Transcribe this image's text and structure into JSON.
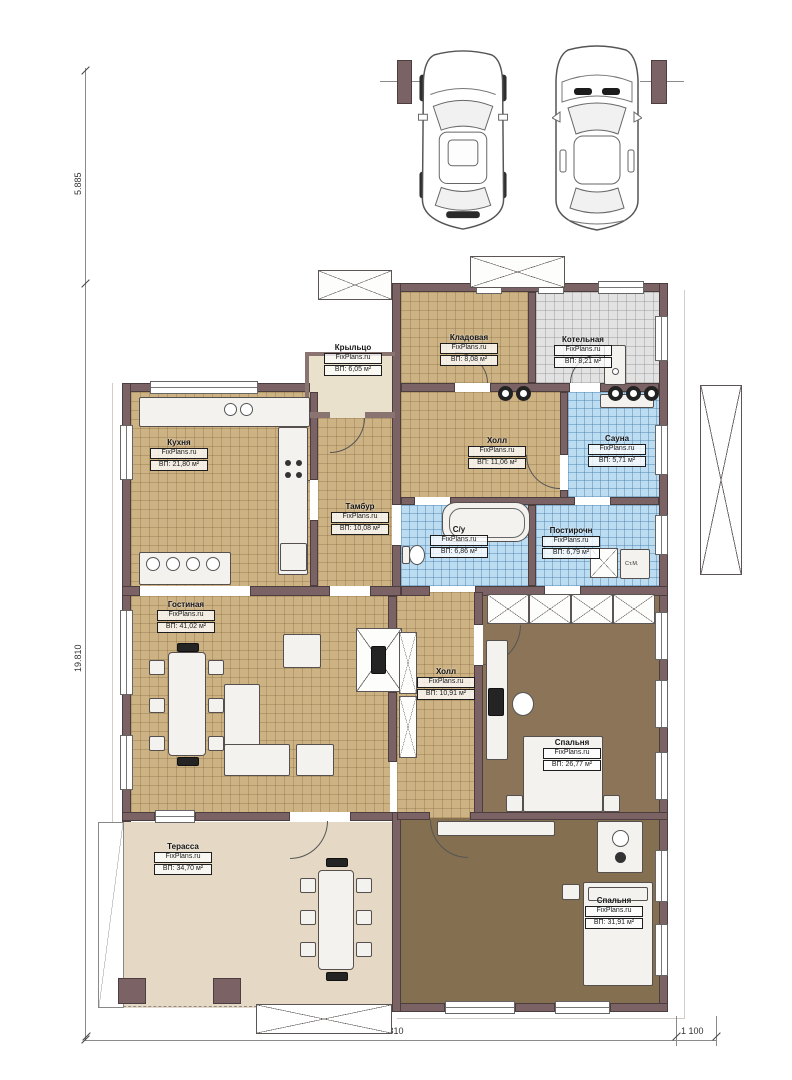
{
  "dimensions": {
    "left_top": "5.885",
    "left_main": "19.810",
    "bottom_main": "14 810",
    "bottom_right": "1 100"
  },
  "rooms": {
    "kryltso": {
      "name": "Крыльцо",
      "watermark": "FixPlans.ru",
      "area": "ВП: 6,05 м²"
    },
    "kladovaya": {
      "name": "Кладовая",
      "watermark": "FixPlans.ru",
      "area": "ВП: 8,08 м²"
    },
    "kotelnaya": {
      "name": "Котельная",
      "watermark": "FixPlans.ru",
      "area": "ВП: 8,21 м²"
    },
    "kuhnya": {
      "name": "Кухня",
      "watermark": "FixPlans.ru",
      "area": "ВП: 21,80 м²"
    },
    "holl1": {
      "name": "Холл",
      "watermark": "FixPlans.ru",
      "area": "ВП: 11,06 м²"
    },
    "sauna": {
      "name": "Сауна",
      "watermark": "FixPlans.ru",
      "area": "ВП: 5,71 м²"
    },
    "tambur": {
      "name": "Тамбур",
      "watermark": "FixPlans.ru",
      "area": "ВП: 10,08 м²"
    },
    "su": {
      "name": "С/у",
      "watermark": "FixPlans.ru",
      "area": "ВП: 6,86 м²"
    },
    "postirochnaya": {
      "name": "Постирочн",
      "watermark": "FixPlans.ru",
      "area": "ВП: 6,79 м²"
    },
    "gostinaya": {
      "name": "Гостиная",
      "watermark": "FixPlans.ru",
      "area": "ВП: 41,02 м²"
    },
    "holl2": {
      "name": "Холл",
      "watermark": "FixPlans.ru",
      "area": "ВП: 10,91 м²"
    },
    "spalnya1": {
      "name": "Спальня",
      "watermark": "FixPlans.ru",
      "area": "ВП: 26,77 м²"
    },
    "terassa": {
      "name": "Терасса",
      "watermark": "FixPlans.ru",
      "area": "ВП: 34,70 м²"
    },
    "spalnya2": {
      "name": "Спальня",
      "watermark": "FixPlans.ru",
      "area": "ВП: 31,91 м²"
    }
  },
  "annotations": {
    "washing_machine": "Ст.М."
  },
  "colors": {
    "wall": "#7b6365",
    "tile_tan": "#cdb283",
    "tile_gray": "#e2e2e2",
    "tile_blue": "#bcdcf1",
    "floor_brown": "#8b7457",
    "terrace": "#e5d9c5"
  }
}
